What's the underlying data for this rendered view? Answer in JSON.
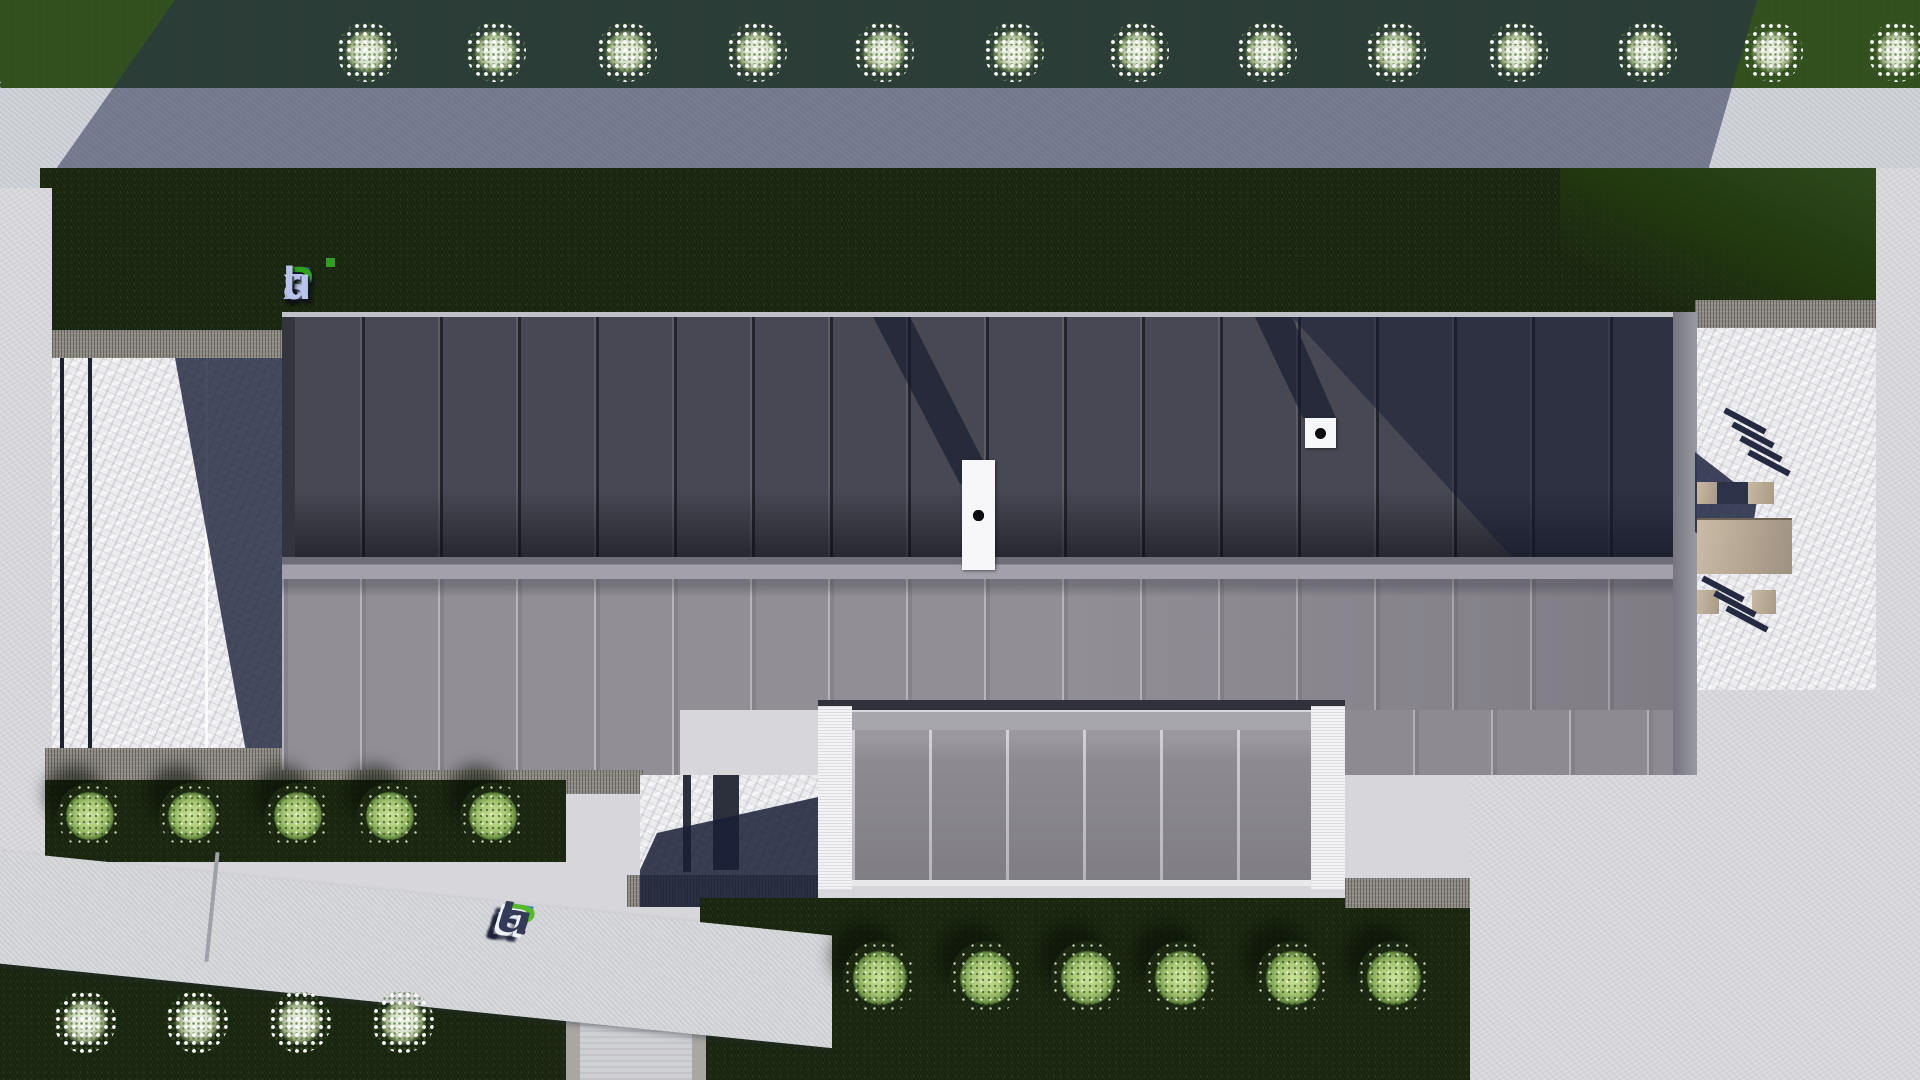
{
  "watermarks": {
    "brand": "FixPlans.ru",
    "top_left_text": "FixPlans.ru",
    "center_logo_text": "FixPlans.ru",
    "bottom_text": "FixPlans.ru"
  },
  "logo_letters": [
    {
      "ch": "F",
      "c": "#2456c8"
    },
    {
      "ch": "i",
      "c": "#b9c4ea"
    },
    {
      "ch": "x",
      "c": "#b9c4ea"
    },
    {
      "ch": "P",
      "c": "#2fa01f"
    },
    {
      "ch": "l",
      "c": "#b9c4ea"
    },
    {
      "ch": "a",
      "c": "#b9c4ea"
    },
    {
      "ch": "n",
      "c": "#b9c4ea"
    },
    {
      "ch": "s",
      "c": "#b9c4ea"
    },
    {
      "ch": ".",
      "c": "#1d2f66"
    },
    {
      "ch": "r",
      "c": "#b9c4ea"
    },
    {
      "ch": "u",
      "c": "#b9c4ea"
    }
  ],
  "wm_top_letters": [
    {
      "ch": "F",
      "c": "#2f7bdb"
    },
    {
      "ch": "i",
      "c": "#cfd9ee"
    },
    {
      "ch": "x",
      "c": "#cfd9ee"
    },
    {
      "ch": "P",
      "c": "#3aa621"
    },
    {
      "ch": "l",
      "c": "#cfd9ee"
    },
    {
      "ch": "a",
      "c": "#dde4f2"
    },
    {
      "ch": "n",
      "c": "#cfd9ee"
    },
    {
      "ch": "s",
      "c": "#e8ecf5"
    },
    {
      "ch": ".",
      "c": "#e8ecf5"
    },
    {
      "ch": "r",
      "c": "#2b3556"
    },
    {
      "ch": "u",
      "c": "#2b3556"
    }
  ],
  "wm_bottom_letters": [
    {
      "ch": "F",
      "c": "#3079d8"
    },
    {
      "ch": "i",
      "c": "#5ec232"
    },
    {
      "ch": "x",
      "c": "#333b58"
    },
    {
      "ch": "P",
      "c": "#55bb2a"
    },
    {
      "ch": "l",
      "c": "#333b58"
    },
    {
      "ch": "a",
      "c": "#333b58"
    },
    {
      "ch": "n",
      "c": "#333b58"
    },
    {
      "ch": "s",
      "c": "#333b58"
    },
    {
      "ch": ".",
      "c": "#2e9be8"
    },
    {
      "ch": "r",
      "c": "#333b58"
    },
    {
      "ch": "u",
      "c": "#333b58"
    }
  ],
  "scene": {
    "description": "Top-down 3D architectural render of a modern flat-roof house with landscaped yard",
    "building": {
      "upper_roof_panels": 18,
      "lower_roof_panels": 18,
      "garage_roof_panels": 6,
      "vent_large_dots": 5,
      "vent_small_dots": 1
    },
    "landscape": {
      "top_white_bushes_x": [
        367,
        496,
        627,
        757,
        884,
        1014,
        1139,
        1267,
        1396,
        1518,
        1647,
        1773,
        1898
      ],
      "left_green_bushes_x": [
        90,
        192,
        298,
        390,
        493
      ],
      "lawn_green_bushes_x": [
        880,
        987,
        1088,
        1182,
        1293,
        1394
      ],
      "bottom_white_bushes_x": [
        85,
        197,
        300,
        403
      ]
    },
    "deck_slats_upper": [
      [
        1722,
        418
      ],
      [
        1730,
        432
      ],
      [
        1738,
        446
      ],
      [
        1746,
        460
      ]
    ],
    "deck_slats_lower": [
      [
        1700,
        586
      ],
      [
        1712,
        601
      ],
      [
        1724,
        616
      ]
    ]
  },
  "palette": {
    "grass_lit": "#2f4e1d",
    "grass_dark": "#131f0b",
    "pavement": "#d7d7db",
    "pavement_shadow": "#78809a",
    "road": "#c9cbd2",
    "roof_upper": "#474853",
    "roof_lower": "#8e8b93",
    "roof_garage": "#928f97",
    "ridge": "#a3a0a9",
    "marble": "#ececef",
    "gravel": "#8e8b84",
    "cast_shadow": "#242c4c",
    "logo_blue": "#2456c8",
    "logo_green": "#2fa01f",
    "logo_light": "#b9c4ea",
    "wood": "#c0b19c"
  }
}
